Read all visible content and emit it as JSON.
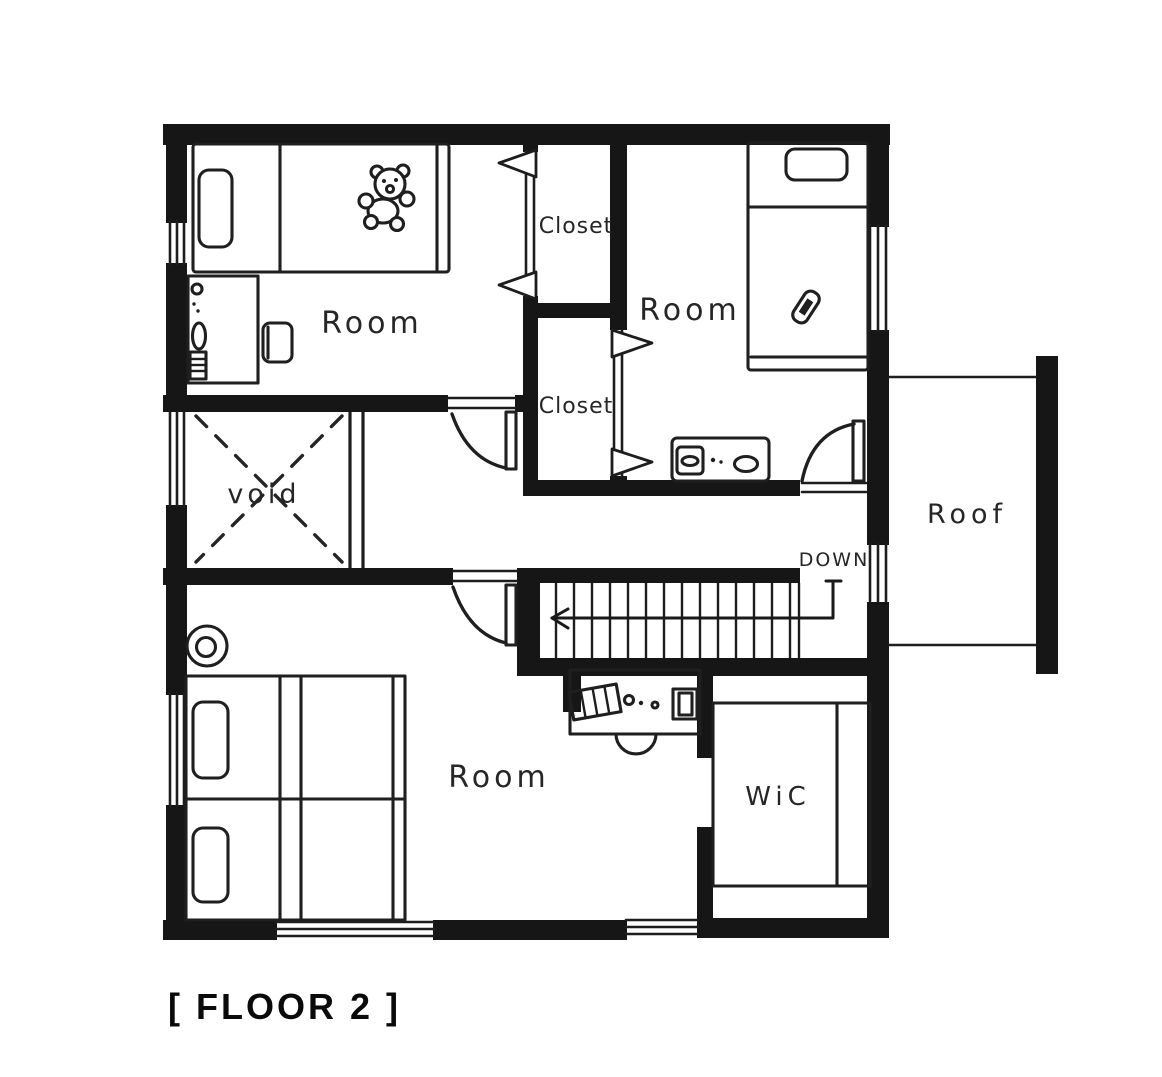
{
  "title": "[ FLOOR 2 ]",
  "colors": {
    "ink": "#161616",
    "paper": "#ffffff"
  },
  "labels": {
    "room_top_left": "Room",
    "room_top_right": "Room",
    "room_bottom": "Room",
    "closet_top": "Closet",
    "closet_bottom": "Closet",
    "void_area": "void",
    "roof": "Roof",
    "wic": "WiC",
    "stairs": "DOWN"
  }
}
